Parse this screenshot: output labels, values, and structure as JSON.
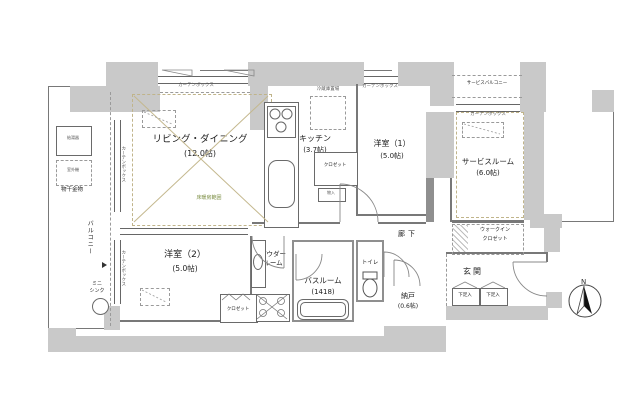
{
  "rooms": {
    "living": {
      "name": "リビング・ダイニング",
      "size": "(12.0帖)"
    },
    "kitchen": {
      "name": "キッチン",
      "size": "(3.7帖)"
    },
    "bedroom1": {
      "name": "洋室（1）",
      "size": "(5.0帖)"
    },
    "bedroom2": {
      "name": "洋室（2）",
      "size": "(5.0帖)"
    },
    "service_room": {
      "name": "サービスルーム",
      "size": "(6.0帖)"
    },
    "powder_room": {
      "name1": "パウダー",
      "name2": "ルーム"
    },
    "bathroom": {
      "name": "バスルーム",
      "size": "(1418)"
    },
    "toilet": {
      "name": "トイレ"
    },
    "storage": {
      "name": "納戸",
      "size": "(0.6帖)"
    },
    "hallway": {
      "name": "廊下"
    },
    "entrance": {
      "name": "玄関"
    },
    "balcony": {
      "name": "バルコニー"
    },
    "service_balcony": {
      "name": "サービスバルコニー"
    },
    "walk_in_closet": {
      "name1": "ウォークイン",
      "name2": "クロゼット"
    }
  },
  "fixtures": {
    "closet_bedroom1": "クロゼット",
    "closet_bedroom2": "クロゼット",
    "storage_small": "物入",
    "fridge_space": "冷蔵庫置場",
    "curtain_box": "カーテンボックス",
    "floor_heating": "床暖房範囲",
    "shoe_cabinet": "下足入",
    "mini_sink1": "ミニ",
    "mini_sink2": "シンク",
    "laundry_hardware": "物干金物",
    "water_heater": "給湯器",
    "outdoor_unit": "室外機",
    "compass_north": "N"
  },
  "colors": {
    "wall": "#c9c9c9",
    "line": "#787878",
    "tatami": "#c0b48a",
    "floor_heating_text": "#7d8f45"
  }
}
